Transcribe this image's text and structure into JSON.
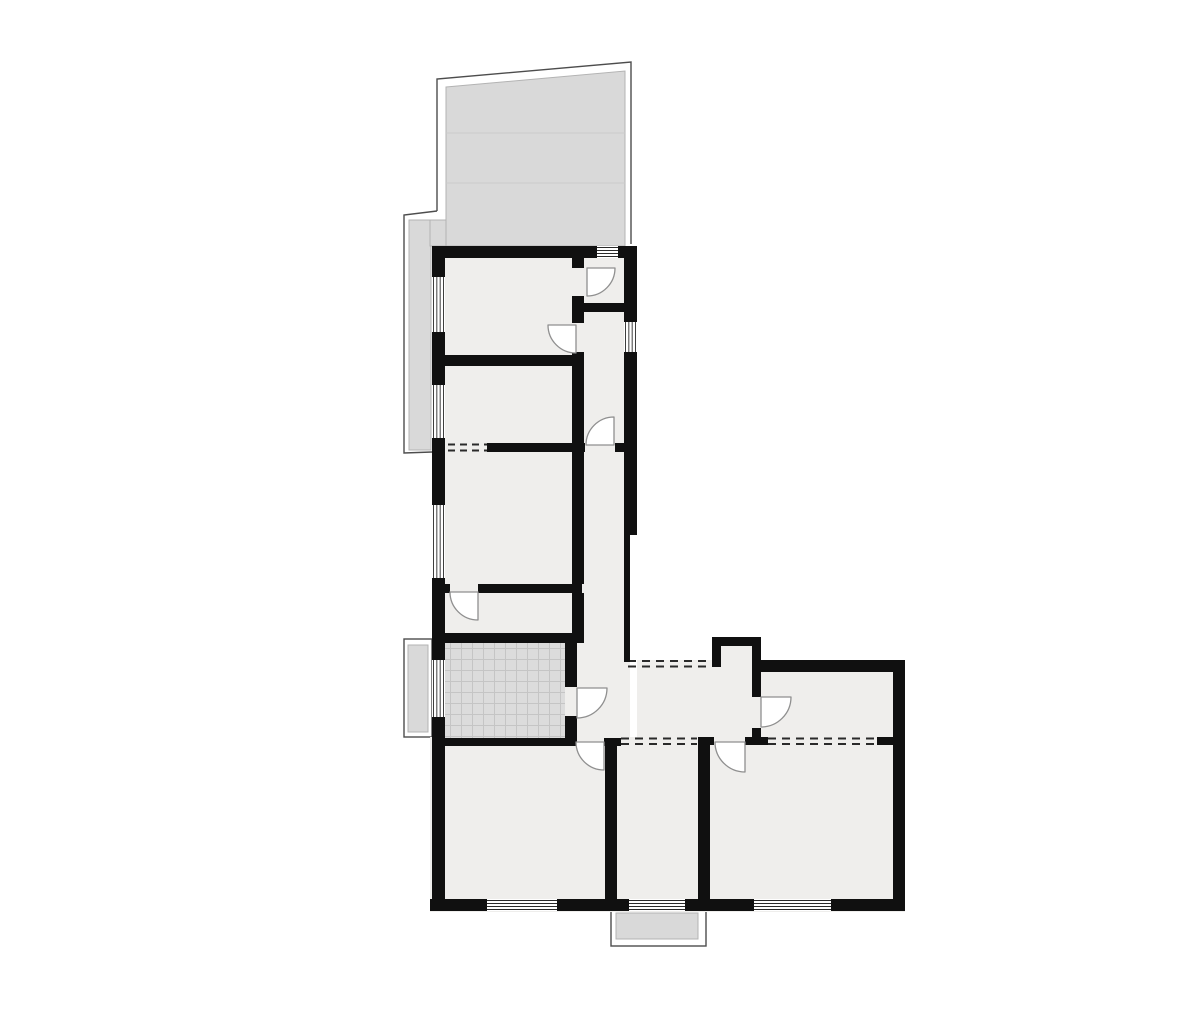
{
  "canvas": {
    "width": 1200,
    "height": 1010,
    "background": "#ffffff"
  },
  "palette": {
    "wall": "#101010",
    "floor": "#efeeec",
    "terrace": "#d9d9d9",
    "terraceStroke": "#b3b3b3",
    "outline": "#4d4d4d",
    "windowLine": "#2a2a2a",
    "doorStroke": "#8f8f8f",
    "doorFill": "#ffffff",
    "hatchBg": "#dcdcdc",
    "hatchLine": "#c5c5c5",
    "dash": "#2a2a2a",
    "deckLine": "#cacaca",
    "windowFill": "#ffffff"
  },
  "hatch": {
    "size": 11
  },
  "elements": [
    {
      "kind": "path",
      "name": "terrace-outline-right",
      "d": "M 437,211 L 437,79 L 631,62 L 631,244",
      "stroke": "outline",
      "sw": 1.4
    },
    {
      "kind": "path",
      "name": "terrace-outline-left",
      "d": "M 437,211 L 404,215 L 404,453 L 432,452",
      "stroke": "outline",
      "sw": 1.4
    },
    {
      "kind": "path",
      "name": "terrace-deck",
      "d": "M 446,87 L 625,71 L 625,246 L 446,246 Z",
      "fill": "terrace",
      "stroke": "terraceStroke",
      "sw": 1
    },
    {
      "kind": "rect",
      "name": "terrace-deck-strip",
      "x": 409,
      "y": 220,
      "w": 22,
      "h": 230,
      "fill": "terrace",
      "stroke": "terraceStroke",
      "sw": 1
    },
    {
      "kind": "rect",
      "name": "terrace-deck-corner",
      "x": 430,
      "y": 220,
      "w": 16,
      "h": 26,
      "fill": "terrace",
      "stroke": "terraceStroke",
      "sw": 1
    },
    {
      "kind": "line",
      "name": "terrace-deck-line",
      "x1": 446,
      "y1": 133,
      "x2": 625,
      "y2": 133,
      "stroke": "deckLine",
      "sw": 1
    },
    {
      "kind": "line",
      "name": "terrace-deck-line",
      "x1": 446,
      "y1": 183,
      "x2": 625,
      "y2": 183,
      "stroke": "deckLine",
      "sw": 1
    },
    {
      "kind": "rect",
      "name": "left-balcony-outline",
      "x": 404,
      "y": 639,
      "w": 28,
      "h": 98,
      "fill": "none",
      "stroke": "outline",
      "sw": 1.4
    },
    {
      "kind": "rect",
      "name": "left-balcony-deck",
      "x": 408,
      "y": 645,
      "w": 20,
      "h": 87,
      "fill": "terrace",
      "stroke": "terraceStroke",
      "sw": 1
    },
    {
      "kind": "rect",
      "name": "bottom-balcony-outline",
      "x": 611,
      "y": 911,
      "w": 95,
      "h": 35,
      "fill": "none",
      "stroke": "outline",
      "sw": 1.4
    },
    {
      "kind": "rect",
      "name": "bottom-balcony-deck",
      "x": 616,
      "y": 913,
      "w": 82,
      "h": 26,
      "fill": "terrace",
      "stroke": "terraceStroke",
      "sw": 1
    },
    {
      "kind": "rect",
      "name": "floor-upper-wing",
      "x": 432,
      "y": 246,
      "w": 198,
      "h": 500,
      "fill": "floor"
    },
    {
      "kind": "rect",
      "name": "floor-entry-niche",
      "x": 712,
      "y": 637,
      "w": 49,
      "h": 30,
      "fill": "floor"
    },
    {
      "kind": "rect",
      "name": "floor-right-wing",
      "x": 637,
      "y": 660,
      "w": 268,
      "h": 86,
      "fill": "floor"
    },
    {
      "kind": "rect",
      "name": "floor-bottom-block",
      "x": 430,
      "y": 737,
      "w": 475,
      "h": 175,
      "fill": "floor"
    },
    {
      "kind": "hatch",
      "name": "kitchen-tiled-floor",
      "x": 445,
      "y": 643,
      "w": 120,
      "h": 95
    },
    {
      "kind": "line",
      "name": "dashed-opening",
      "x1": 448,
      "y1": 444.5,
      "x2": 487,
      "y2": 444.5,
      "stroke": "dash",
      "sw": 2,
      "dash": "7 5"
    },
    {
      "kind": "line",
      "name": "dashed-opening",
      "x1": 448,
      "y1": 450.5,
      "x2": 487,
      "y2": 450.5,
      "stroke": "dash",
      "sw": 2,
      "dash": "7 5"
    },
    {
      "kind": "line",
      "name": "dashed-opening",
      "x1": 628,
      "y1": 661,
      "x2": 712,
      "y2": 661,
      "stroke": "dash",
      "sw": 2,
      "dash": "8 6"
    },
    {
      "kind": "line",
      "name": "dashed-opening",
      "x1": 628,
      "y1": 666.5,
      "x2": 712,
      "y2": 666.5,
      "stroke": "dash",
      "sw": 2,
      "dash": "8 6"
    },
    {
      "kind": "line",
      "name": "dashed-opening",
      "x1": 621,
      "y1": 738.5,
      "x2": 697,
      "y2": 738.5,
      "stroke": "dash",
      "sw": 2,
      "dash": "8 6"
    },
    {
      "kind": "line",
      "name": "dashed-opening",
      "x1": 621,
      "y1": 744,
      "x2": 697,
      "y2": 744,
      "stroke": "dash",
      "sw": 2,
      "dash": "8 6"
    },
    {
      "kind": "line",
      "name": "dashed-opening",
      "x1": 768,
      "y1": 738.5,
      "x2": 877,
      "y2": 738.5,
      "stroke": "dash",
      "sw": 2,
      "dash": "8 6"
    },
    {
      "kind": "line",
      "name": "dashed-opening",
      "x1": 768,
      "y1": 744,
      "x2": 877,
      "y2": 744,
      "stroke": "dash",
      "sw": 2,
      "dash": "8 6"
    },
    {
      "kind": "rect",
      "name": "wall",
      "x": 432,
      "y": 246,
      "w": 165,
      "h": 12,
      "fill": "wall"
    },
    {
      "kind": "rect",
      "name": "wall",
      "x": 618,
      "y": 246,
      "w": 19,
      "h": 12,
      "fill": "wall"
    },
    {
      "kind": "rect",
      "name": "wall",
      "x": 432,
      "y": 246,
      "w": 13,
      "h": 31,
      "fill": "wall"
    },
    {
      "kind": "rect",
      "name": "wall",
      "x": 432,
      "y": 332,
      "w": 13,
      "h": 53,
      "fill": "wall"
    },
    {
      "kind": "rect",
      "name": "wall",
      "x": 432,
      "y": 438,
      "w": 13,
      "h": 67,
      "fill": "wall"
    },
    {
      "kind": "rect",
      "name": "wall",
      "x": 432,
      "y": 578,
      "w": 13,
      "h": 82,
      "fill": "wall"
    },
    {
      "kind": "rect",
      "name": "wall",
      "x": 432,
      "y": 717,
      "w": 13,
      "h": 193,
      "fill": "wall"
    },
    {
      "kind": "rect",
      "name": "wall",
      "x": 624,
      "y": 246,
      "w": 13,
      "h": 76,
      "fill": "wall"
    },
    {
      "kind": "rect",
      "name": "wall",
      "x": 624,
      "y": 352,
      "w": 13,
      "h": 183,
      "fill": "wall"
    },
    {
      "kind": "rect",
      "name": "wall",
      "x": 624,
      "y": 535,
      "w": 6,
      "h": 127,
      "fill": "wall"
    },
    {
      "kind": "rect",
      "name": "wall",
      "x": 712,
      "y": 637,
      "w": 9,
      "h": 30,
      "fill": "wall"
    },
    {
      "kind": "rect",
      "name": "wall",
      "x": 712,
      "y": 637,
      "w": 48,
      "h": 9,
      "fill": "wall"
    },
    {
      "kind": "rect",
      "name": "wall",
      "x": 752,
      "y": 637,
      "w": 9,
      "h": 60,
      "fill": "wall"
    },
    {
      "kind": "rect",
      "name": "wall",
      "x": 752,
      "y": 728,
      "w": 9,
      "h": 17,
      "fill": "wall"
    },
    {
      "kind": "rect",
      "name": "wall",
      "x": 752,
      "y": 660,
      "w": 153,
      "h": 12,
      "fill": "wall"
    },
    {
      "kind": "rect",
      "name": "wall",
      "x": 893,
      "y": 660,
      "w": 12,
      "h": 250,
      "fill": "wall"
    },
    {
      "kind": "rect",
      "name": "wall",
      "x": 430,
      "y": 899,
      "w": 57,
      "h": 12,
      "fill": "wall"
    },
    {
      "kind": "rect",
      "name": "wall",
      "x": 557,
      "y": 899,
      "w": 72,
      "h": 12,
      "fill": "wall"
    },
    {
      "kind": "rect",
      "name": "wall",
      "x": 685,
      "y": 899,
      "w": 69,
      "h": 12,
      "fill": "wall"
    },
    {
      "kind": "rect",
      "name": "wall",
      "x": 831,
      "y": 899,
      "w": 74,
      "h": 12,
      "fill": "wall"
    },
    {
      "kind": "rect",
      "name": "wall",
      "x": 445,
      "y": 355,
      "w": 137,
      "h": 11,
      "fill": "wall"
    },
    {
      "kind": "rect",
      "name": "wall",
      "x": 487,
      "y": 443,
      "w": 98,
      "h": 9,
      "fill": "wall"
    },
    {
      "kind": "rect",
      "name": "wall",
      "x": 615,
      "y": 443,
      "w": 22,
      "h": 9,
      "fill": "wall"
    },
    {
      "kind": "rect",
      "name": "wall",
      "x": 445,
      "y": 584,
      "w": 5,
      "h": 9,
      "fill": "wall"
    },
    {
      "kind": "rect",
      "name": "wall",
      "x": 478,
      "y": 584,
      "w": 104,
      "h": 9,
      "fill": "wall"
    },
    {
      "kind": "rect",
      "name": "wall",
      "x": 445,
      "y": 633,
      "w": 139,
      "h": 10,
      "fill": "wall"
    },
    {
      "kind": "rect",
      "name": "wall",
      "x": 432,
      "y": 738,
      "w": 145,
      "h": 8,
      "fill": "wall"
    },
    {
      "kind": "rect",
      "name": "wall",
      "x": 604,
      "y": 738,
      "w": 17,
      "h": 8,
      "fill": "wall"
    },
    {
      "kind": "rect",
      "name": "wall",
      "x": 572,
      "y": 258,
      "w": 12,
      "h": 10,
      "fill": "wall"
    },
    {
      "kind": "rect",
      "name": "wall",
      "x": 572,
      "y": 296,
      "w": 12,
      "h": 27,
      "fill": "wall"
    },
    {
      "kind": "rect",
      "name": "wall",
      "x": 572,
      "y": 352,
      "w": 12,
      "h": 91,
      "fill": "wall"
    },
    {
      "kind": "rect",
      "name": "wall",
      "x": 572,
      "y": 452,
      "w": 12,
      "h": 132,
      "fill": "wall"
    },
    {
      "kind": "rect",
      "name": "wall",
      "x": 572,
      "y": 593,
      "w": 12,
      "h": 40,
      "fill": "wall"
    },
    {
      "kind": "rect",
      "name": "wall",
      "x": 580,
      "y": 303,
      "w": 57,
      "h": 9,
      "fill": "wall"
    },
    {
      "kind": "rect",
      "name": "wall",
      "x": 565,
      "y": 643,
      "w": 12,
      "h": 44,
      "fill": "wall"
    },
    {
      "kind": "rect",
      "name": "wall",
      "x": 565,
      "y": 716,
      "w": 12,
      "h": 29,
      "fill": "wall"
    },
    {
      "kind": "rect",
      "name": "wall",
      "x": 605,
      "y": 742,
      "w": 12,
      "h": 161,
      "fill": "wall"
    },
    {
      "kind": "rect",
      "name": "wall",
      "x": 698,
      "y": 742,
      "w": 12,
      "h": 161,
      "fill": "wall"
    },
    {
      "kind": "rect",
      "name": "wall",
      "x": 698,
      "y": 737,
      "w": 16,
      "h": 8,
      "fill": "wall"
    },
    {
      "kind": "rect",
      "name": "wall",
      "x": 745,
      "y": 737,
      "w": 23,
      "h": 8,
      "fill": "wall"
    },
    {
      "kind": "rect",
      "name": "wall",
      "x": 877,
      "y": 737,
      "w": 16,
      "h": 8,
      "fill": "wall"
    },
    {
      "kind": "window",
      "name": "window",
      "x": 597,
      "y": 246,
      "w": 21,
      "h": 12,
      "o": "h"
    },
    {
      "kind": "window",
      "name": "window",
      "x": 432,
      "y": 277,
      "w": 13,
      "h": 55,
      "o": "v"
    },
    {
      "kind": "window",
      "name": "window",
      "x": 432,
      "y": 385,
      "w": 13,
      "h": 53,
      "o": "v"
    },
    {
      "kind": "window",
      "name": "window",
      "x": 432,
      "y": 505,
      "w": 13,
      "h": 73,
      "o": "v"
    },
    {
      "kind": "window",
      "name": "window",
      "x": 432,
      "y": 660,
      "w": 13,
      "h": 57,
      "o": "v"
    },
    {
      "kind": "window",
      "name": "window",
      "x": 624,
      "y": 322,
      "w": 13,
      "h": 30,
      "o": "v"
    },
    {
      "kind": "window",
      "name": "window",
      "x": 487,
      "y": 899,
      "w": 70,
      "h": 12,
      "o": "h"
    },
    {
      "kind": "window",
      "name": "window",
      "x": 629,
      "y": 899,
      "w": 56,
      "h": 12,
      "o": "h"
    },
    {
      "kind": "window",
      "name": "window",
      "x": 754,
      "y": 899,
      "w": 77,
      "h": 12,
      "o": "h"
    },
    {
      "kind": "door",
      "name": "door-arc",
      "hx": 587,
      "hy": 268,
      "r": 28,
      "dx": 1,
      "dy": 1
    },
    {
      "kind": "door",
      "name": "door-arc",
      "hx": 576,
      "hy": 325,
      "r": 28,
      "dx": -1,
      "dy": 1
    },
    {
      "kind": "door",
      "name": "door-arc",
      "hx": 614,
      "hy": 445,
      "r": 28,
      "dx": -1,
      "dy": -1
    },
    {
      "kind": "door",
      "name": "door-arc",
      "hx": 478,
      "hy": 592,
      "r": 28,
      "dx": -1,
      "dy": 1
    },
    {
      "kind": "door",
      "name": "door-arc",
      "hx": 577,
      "hy": 688,
      "r": 30,
      "dx": 1,
      "dy": 1
    },
    {
      "kind": "door",
      "name": "door-arc",
      "hx": 604,
      "hy": 742,
      "r": 28,
      "dx": -1,
      "dy": 1
    },
    {
      "kind": "door",
      "name": "door-arc",
      "hx": 745,
      "hy": 742,
      "r": 30,
      "dx": -1,
      "dy": 1
    },
    {
      "kind": "door",
      "name": "door-arc",
      "hx": 761,
      "hy": 697,
      "r": 30,
      "dx": 1,
      "dy": 1
    }
  ]
}
